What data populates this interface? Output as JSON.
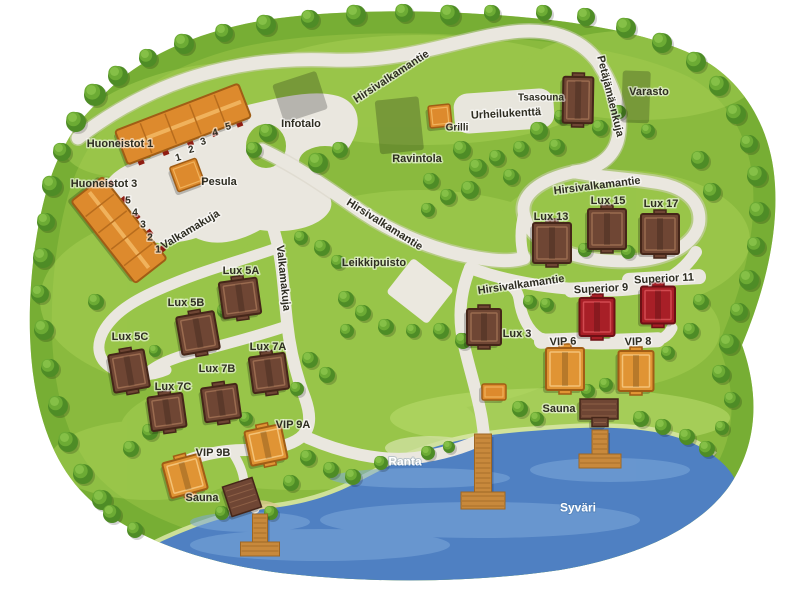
{
  "map": {
    "title": "Holiday village map",
    "lake_name": "Syväri",
    "colors": {
      "land": "#8aba3e",
      "landEdge": "#67a42c",
      "landLight": "#a7d054",
      "water": "#4f80c2",
      "waterLight": "#7da8da",
      "road": "#eae7df",
      "roadEdge": "#d7d3c5",
      "field": "#e8e6dd",
      "sand": "#ebe8df",
      "shoreSand": "#d6e5a2",
      "beach": "#d9c98f",
      "orange_fill": "#dd8a2d",
      "orange_stroke": "#a05d15",
      "orange_trim": "#f0b25c",
      "vip_fill": "#e09434",
      "vip_trim": "#f4c276",
      "brown_fill": "#6f4634",
      "brown_stroke": "#452619",
      "brown_trim": "#9a6b4f",
      "red_fill": "#a81f27",
      "red_stroke": "#6d1015",
      "red_trim": "#d24a50",
      "pier_fill": "#c8893c",
      "pier_stroke": "#9d6624",
      "pier_plank": "#a8702a",
      "label_dark": "#2e2d22",
      "label_white": "#ffffff"
    }
  },
  "labels": [
    {
      "id": "huoneistot-1-label",
      "text": "Huoneistot 1",
      "x": 120,
      "y": 143,
      "rot": 0,
      "cls": "dark",
      "size": 11
    },
    {
      "id": "huoneistot-3-label",
      "text": "Huoneistot 3",
      "x": 104,
      "y": 183,
      "rot": 0,
      "cls": "dark",
      "size": 11
    },
    {
      "id": "pesula-label",
      "text": "Pesula",
      "x": 219,
      "y": 181,
      "rot": 0,
      "cls": "dark",
      "size": 11
    },
    {
      "id": "infotalo-label",
      "text": "Infotalo",
      "x": 301,
      "y": 123,
      "rot": 0,
      "cls": "dark",
      "size": 11
    },
    {
      "id": "ravintola-label",
      "text": "Ravintola",
      "x": 417,
      "y": 158,
      "rot": 0,
      "cls": "dark",
      "size": 11
    },
    {
      "id": "grilli-label",
      "text": "Grilli",
      "x": 457,
      "y": 127,
      "rot": 0,
      "cls": "dark",
      "size": 10
    },
    {
      "id": "urheilukentta-label",
      "text": "Urheilukenttä",
      "x": 506,
      "y": 113,
      "rot": -3,
      "cls": "dark",
      "size": 11
    },
    {
      "id": "tsasouna-label",
      "text": "Tsasouna",
      "x": 541,
      "y": 97,
      "rot": 0,
      "cls": "dark",
      "size": 10
    },
    {
      "id": "varasto-label",
      "text": "Varasto",
      "x": 649,
      "y": 91,
      "rot": 0,
      "cls": "dark",
      "size": 11
    },
    {
      "id": "road-hirsivalkamantie-top",
      "text": "Hirsivalkamantie",
      "x": 391,
      "y": 76,
      "rot": -33,
      "cls": "dark",
      "size": 11
    },
    {
      "id": "road-petajamaenkuja",
      "text": "Petäjämäenkuja",
      "x": 611,
      "y": 96,
      "rot": 76,
      "cls": "dark",
      "size": 11
    },
    {
      "id": "road-hirsivalkamantie-right",
      "text": "Hirsivalkamantie",
      "x": 597,
      "y": 185,
      "rot": -7,
      "cls": "dark",
      "size": 11
    },
    {
      "id": "road-hirsivalkamantie-mid",
      "text": "Hirsivalkamantie",
      "x": 385,
      "y": 224,
      "rot": 32,
      "cls": "dark",
      "size": 11
    },
    {
      "id": "road-hirsivalkamantie-center",
      "text": "Hirsivalkamantie",
      "x": 521,
      "y": 284,
      "rot": -8,
      "cls": "dark",
      "size": 11
    },
    {
      "id": "road-valkamakuja-upper",
      "text": "Valkamakuja",
      "x": 190,
      "y": 229,
      "rot": -31,
      "cls": "dark",
      "size": 11
    },
    {
      "id": "road-valkamakuja-lower",
      "text": "Valkamakuja",
      "x": 284,
      "y": 278,
      "rot": 84,
      "cls": "dark",
      "size": 11
    },
    {
      "id": "leikkipuisto-label",
      "text": "Leikkipuisto",
      "x": 374,
      "y": 262,
      "rot": 0,
      "cls": "dark",
      "size": 11
    },
    {
      "id": "lux-13-label",
      "text": "Lux 13",
      "x": 551,
      "y": 216,
      "rot": 0,
      "cls": "dark",
      "size": 11
    },
    {
      "id": "lux-15-label",
      "text": "Lux 15",
      "x": 608,
      "y": 200,
      "rot": 0,
      "cls": "dark",
      "size": 11
    },
    {
      "id": "lux-17-label",
      "text": "Lux 17",
      "x": 661,
      "y": 203,
      "rot": 0,
      "cls": "dark",
      "size": 11
    },
    {
      "id": "superior-9-label",
      "text": "Superior 9",
      "x": 601,
      "y": 288,
      "rot": -3,
      "cls": "dark",
      "size": 11
    },
    {
      "id": "superior-11-label",
      "text": "Superior 11",
      "x": 664,
      "y": 278,
      "rot": -3,
      "cls": "dark",
      "size": 11
    },
    {
      "id": "lux-3-label",
      "text": "Lux 3",
      "x": 517,
      "y": 333,
      "rot": 0,
      "cls": "dark",
      "size": 11
    },
    {
      "id": "vip-6-label",
      "text": "VIP 6",
      "x": 563,
      "y": 341,
      "rot": -2,
      "cls": "dark",
      "size": 11
    },
    {
      "id": "vip-8-label",
      "text": "VIP 8",
      "x": 638,
      "y": 341,
      "rot": -2,
      "cls": "dark",
      "size": 11
    },
    {
      "id": "sauna-right-label",
      "text": "Sauna",
      "x": 559,
      "y": 408,
      "rot": 0,
      "cls": "dark",
      "size": 11
    },
    {
      "id": "lux-5a-label",
      "text": "Lux 5A",
      "x": 241,
      "y": 270,
      "rot": 0,
      "cls": "dark",
      "size": 11
    },
    {
      "id": "lux-5b-label",
      "text": "Lux 5B",
      "x": 186,
      "y": 302,
      "rot": 0,
      "cls": "dark",
      "size": 11
    },
    {
      "id": "lux-5c-label",
      "text": "Lux 5C",
      "x": 130,
      "y": 336,
      "rot": 0,
      "cls": "dark",
      "size": 11
    },
    {
      "id": "lux-7a-label",
      "text": "Lux 7A",
      "x": 268,
      "y": 346,
      "rot": 0,
      "cls": "dark",
      "size": 11
    },
    {
      "id": "lux-7b-label",
      "text": "Lux 7B",
      "x": 217,
      "y": 368,
      "rot": 0,
      "cls": "dark",
      "size": 11
    },
    {
      "id": "lux-7c-label",
      "text": "Lux 7C",
      "x": 173,
      "y": 386,
      "rot": 0,
      "cls": "dark",
      "size": 11
    },
    {
      "id": "vip-9a-label",
      "text": "VIP 9A",
      "x": 293,
      "y": 424,
      "rot": 0,
      "cls": "dark",
      "size": 11
    },
    {
      "id": "vip-9b-label",
      "text": "VIP 9B",
      "x": 213,
      "y": 452,
      "rot": 0,
      "cls": "dark",
      "size": 11
    },
    {
      "id": "sauna-left-label",
      "text": "Sauna",
      "x": 202,
      "y": 497,
      "rot": 0,
      "cls": "dark",
      "size": 11
    },
    {
      "id": "ranta-label",
      "text": "Ranta",
      "x": 405,
      "y": 461,
      "rot": 0,
      "cls": "white",
      "size": 12
    },
    {
      "id": "syvari-label",
      "text": "Syväri",
      "x": 578,
      "y": 507,
      "rot": 0,
      "cls": "white",
      "size": 12
    },
    {
      "id": "h1-unit-1",
      "text": "1",
      "x": 178,
      "y": 157,
      "rot": -15,
      "cls": "dark",
      "size": 10
    },
    {
      "id": "h1-unit-2",
      "text": "2",
      "x": 191,
      "y": 149,
      "rot": -15,
      "cls": "dark",
      "size": 10
    },
    {
      "id": "h1-unit-3",
      "text": "3",
      "x": 203,
      "y": 141,
      "rot": -15,
      "cls": "dark",
      "size": 10
    },
    {
      "id": "h1-unit-4",
      "text": "4",
      "x": 215,
      "y": 132,
      "rot": -15,
      "cls": "dark",
      "size": 10
    },
    {
      "id": "h1-unit-5",
      "text": "5",
      "x": 228,
      "y": 126,
      "rot": -15,
      "cls": "dark",
      "size": 10
    },
    {
      "id": "h3-unit-5",
      "text": "5",
      "x": 128,
      "y": 200,
      "rot": 0,
      "cls": "dark",
      "size": 10
    },
    {
      "id": "h3-unit-4",
      "text": "4",
      "x": 135,
      "y": 212,
      "rot": 0,
      "cls": "dark",
      "size": 10
    },
    {
      "id": "h3-unit-3",
      "text": "3",
      "x": 143,
      "y": 224,
      "rot": 0,
      "cls": "dark",
      "size": 10
    },
    {
      "id": "h3-unit-2",
      "text": "2",
      "x": 150,
      "y": 237,
      "rot": 0,
      "cls": "dark",
      "size": 10
    },
    {
      "id": "h3-unit-1",
      "text": "1",
      "x": 158,
      "y": 249,
      "rot": 0,
      "cls": "dark",
      "size": 10
    }
  ],
  "buildings": [
    {
      "id": "huoneistot-1-building",
      "type": "apartment",
      "x": 183,
      "y": 124,
      "w": 132,
      "h": 36,
      "rot": -21,
      "dashSide": 1
    },
    {
      "id": "huoneistot-3-building",
      "type": "apartment",
      "x": 119,
      "y": 230,
      "w": 104,
      "h": 40,
      "rot": 52,
      "dashSide": -1
    },
    {
      "id": "pesula-building",
      "type": "hut",
      "pal": "orange",
      "x": 187,
      "y": 175,
      "w": 28,
      "h": 26,
      "rot": -20
    },
    {
      "id": "infotalo-building",
      "type": "service",
      "pal": "orange",
      "x": 302,
      "y": 93,
      "w": 46,
      "h": 40,
      "rot": -18
    },
    {
      "id": "ravintola-building",
      "type": "service",
      "pal": "orange",
      "x": 402,
      "y": 122,
      "w": 44,
      "h": 54,
      "rot": -6
    },
    {
      "id": "grilli-building",
      "type": "hut",
      "pal": "orange",
      "x": 440,
      "y": 116,
      "w": 22,
      "h": 22,
      "rot": -6
    },
    {
      "id": "varasto-building",
      "type": "service",
      "pal": "orange",
      "x": 639,
      "y": 94,
      "w": 28,
      "h": 52,
      "rot": 2
    },
    {
      "id": "tsasouna-building",
      "type": "cottage",
      "pal": "brown",
      "x": 578,
      "y": 100,
      "w": 30,
      "h": 46,
      "rot": 1
    },
    {
      "id": "lux-13-building",
      "type": "cottage",
      "pal": "brown",
      "x": 552,
      "y": 243,
      "w": 38,
      "h": 40,
      "rot": 0
    },
    {
      "id": "lux-15-building",
      "type": "cottage",
      "pal": "brown",
      "x": 607,
      "y": 229,
      "w": 38,
      "h": 40,
      "rot": 0
    },
    {
      "id": "lux-17-building",
      "type": "cottage",
      "pal": "brown",
      "x": 660,
      "y": 234,
      "w": 38,
      "h": 40,
      "rot": 0
    },
    {
      "id": "lux-3-building",
      "type": "cottage",
      "pal": "brown",
      "x": 484,
      "y": 327,
      "w": 34,
      "h": 36,
      "rot": 0
    },
    {
      "id": "lux-5a-building",
      "type": "cottage",
      "pal": "brown",
      "x": 240,
      "y": 298,
      "w": 38,
      "h": 36,
      "rot": -8
    },
    {
      "id": "lux-5b-building",
      "type": "cottage",
      "pal": "brown",
      "x": 198,
      "y": 333,
      "w": 38,
      "h": 38,
      "rot": -10
    },
    {
      "id": "lux-5c-building",
      "type": "cottage",
      "pal": "brown",
      "x": 129,
      "y": 371,
      "w": 36,
      "h": 38,
      "rot": -10
    },
    {
      "id": "lux-7a-building",
      "type": "cottage",
      "pal": "brown",
      "x": 269,
      "y": 373,
      "w": 36,
      "h": 36,
      "rot": -8
    },
    {
      "id": "lux-7b-building",
      "type": "cottage",
      "pal": "brown",
      "x": 221,
      "y": 403,
      "w": 36,
      "h": 34,
      "rot": -8
    },
    {
      "id": "lux-7c-building",
      "type": "cottage",
      "pal": "brown",
      "x": 167,
      "y": 412,
      "w": 35,
      "h": 34,
      "rot": -8
    },
    {
      "id": "superior-9-building",
      "type": "cottage",
      "pal": "red",
      "x": 597,
      "y": 317,
      "w": 35,
      "h": 38,
      "rot": 0
    },
    {
      "id": "superior-11-building",
      "type": "cottage",
      "pal": "red",
      "x": 658,
      "y": 305,
      "w": 34,
      "h": 37,
      "rot": 0
    },
    {
      "id": "vip-6-building",
      "type": "cottage",
      "pal": "vip",
      "x": 565,
      "y": 369,
      "w": 38,
      "h": 42,
      "rot": 0
    },
    {
      "id": "vip-8-building",
      "type": "cottage",
      "pal": "vip",
      "x": 636,
      "y": 371,
      "w": 35,
      "h": 40,
      "rot": 0
    },
    {
      "id": "vip-9a-building",
      "type": "cottage",
      "pal": "vip",
      "x": 266,
      "y": 445,
      "w": 37,
      "h": 35,
      "rot": -12
    },
    {
      "id": "vip-9b-building",
      "type": "cottage",
      "pal": "vip",
      "x": 185,
      "y": 476,
      "w": 38,
      "h": 36,
      "rot": -15
    },
    {
      "id": "sauna-right-building",
      "type": "flat",
      "pal": "brown",
      "x": 599,
      "y": 409,
      "w": 38,
      "h": 20,
      "rot": 0
    },
    {
      "id": "sauna-right-annex",
      "type": "flat",
      "pal": "brown",
      "x": 600,
      "y": 422,
      "w": 16,
      "h": 9,
      "rot": 0
    },
    {
      "id": "sauna-left-building",
      "type": "flat",
      "pal": "brown",
      "x": 242,
      "y": 497,
      "w": 31,
      "h": 31,
      "rot": -18
    },
    {
      "id": "shore-hut",
      "type": "hut",
      "pal": "orange",
      "x": 494,
      "y": 392,
      "w": 24,
      "h": 16,
      "rot": 0
    }
  ],
  "piers": [
    {
      "id": "pier-left",
      "cx": 260,
      "stemTop": 514,
      "stemW": 15,
      "stemH": 32,
      "baseW": 39,
      "baseH": 14
    },
    {
      "id": "pier-center",
      "cx": 483,
      "stemTop": 434,
      "stemW": 17,
      "stemH": 62,
      "baseW": 44,
      "baseH": 17
    },
    {
      "id": "pier-right",
      "cx": 600,
      "stemTop": 430,
      "stemW": 16,
      "stemH": 28,
      "baseW": 42,
      "baseH": 14
    }
  ]
}
